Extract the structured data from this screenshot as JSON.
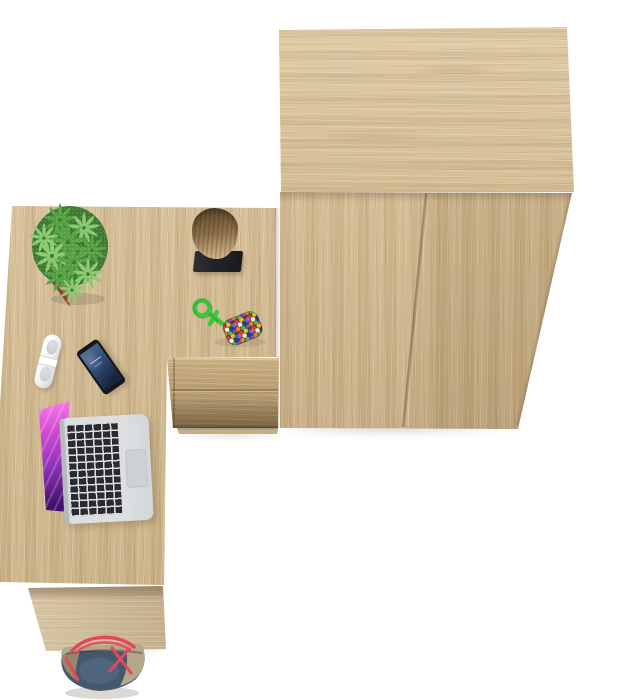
{
  "scene": {
    "description": "Top-down product photo of an L-shaped light oak desk set: desk with laptop, smartphone, white remote and potted succulent; drawer pedestal with wooden stump ornament and beaded keychain; tall two-door oak wardrobe; denim tote bag with red straps on a white floor.",
    "background": "#ffffff"
  },
  "objects": [
    {
      "name": "wardrobe",
      "description": "two-door wardrobe, light oak, top panel and front doors visible"
    },
    {
      "name": "desk",
      "description": "L-shaped desk top, light oak, vertical grain"
    },
    {
      "name": "drawer-unit",
      "description": "drawer pedestal front with two drawers and plinth"
    },
    {
      "name": "desk-side-panel",
      "description": "desk side support panel"
    },
    {
      "name": "potted-plant",
      "description": "speckled green succulent in square terracotta pot"
    },
    {
      "name": "wood-stump",
      "description": "decorative bark stump on black square stand"
    },
    {
      "name": "beaded-keychain",
      "description": "green rope knot with multicoloured beaded pouch"
    },
    {
      "name": "remote",
      "description": "white capsule-shaped remote control"
    },
    {
      "name": "smartphone",
      "description": "black smartphone with dark blue lock screen"
    },
    {
      "name": "laptop",
      "description": "silver laptop, black keys, purple abstract wallpaper"
    },
    {
      "name": "tote-bag",
      "description": "denim and tan tote bag with red straps"
    }
  ],
  "palette": {
    "bg": "#ffffff",
    "shadow_soft": "rgba(110,96,78,0.24)",
    "wood_top_light": "#ddc8a1",
    "wood_top_mid": "#d3bb92",
    "wood_front": "#d0b68a",
    "wood_front_dark": "#c2a67a",
    "wood_desk": "#d6bf97",
    "wood_desk_dark": "#c9ae82",
    "wood_drawer": "#cbaf81",
    "wood_drawer_shadow": "#a2875e",
    "wood_leg": "#d7c5a4",
    "wood_leg_dark": "#c4b08c",
    "plinth": "#c7ad80",
    "plant_dark": "#3e7a31",
    "plant_mid": "#57a343",
    "plant_light": "#8cc973",
    "plant_speckle": "#d2ecbf",
    "pot": "#a8564400",
    "pot_light": "#b15e4c",
    "pot_dark": "#8c4334",
    "stump_dark": "#634d30",
    "stump_mid": "#8c6f47",
    "stump_light": "#c2a577",
    "base_black": "#242428",
    "rope": "#3dc53b",
    "rope_dark": "#2b9025",
    "pouch": "#4f3e2e",
    "bead_red": "#d93a3a",
    "bead_yellow": "#f0b929",
    "bead_blue": "#3a74d8",
    "bead_white": "#f2f2f2",
    "bead_green": "#52b347",
    "bead_navy": "#1d3f86",
    "bead_orange": "#ef7a2e",
    "bead_purple": "#8c46c8",
    "bead_pink": "#e05a96",
    "remote_gray": "#c7c9cc",
    "phone_body": "#141619",
    "phone_screen_light": "#4c6a8e",
    "phone_screen_dark": "#16253f",
    "laptop_silver": "#dcdee0",
    "laptop_silver_dark": "#bcc0c3",
    "key_black": "#2a2b2e",
    "trackpad": "#ced2d4",
    "screen_pink": "#ff86ef",
    "screen_magenta": "#d84fd6",
    "screen_purple": "#9032bd",
    "screen_deep": "#43106a",
    "bag_denim": "#46586e",
    "bag_denim_light": "#5c7693",
    "bag_tan": "#b5a78a",
    "bag_tan_dark": "#97876a",
    "bag_red": "#e2475c"
  }
}
